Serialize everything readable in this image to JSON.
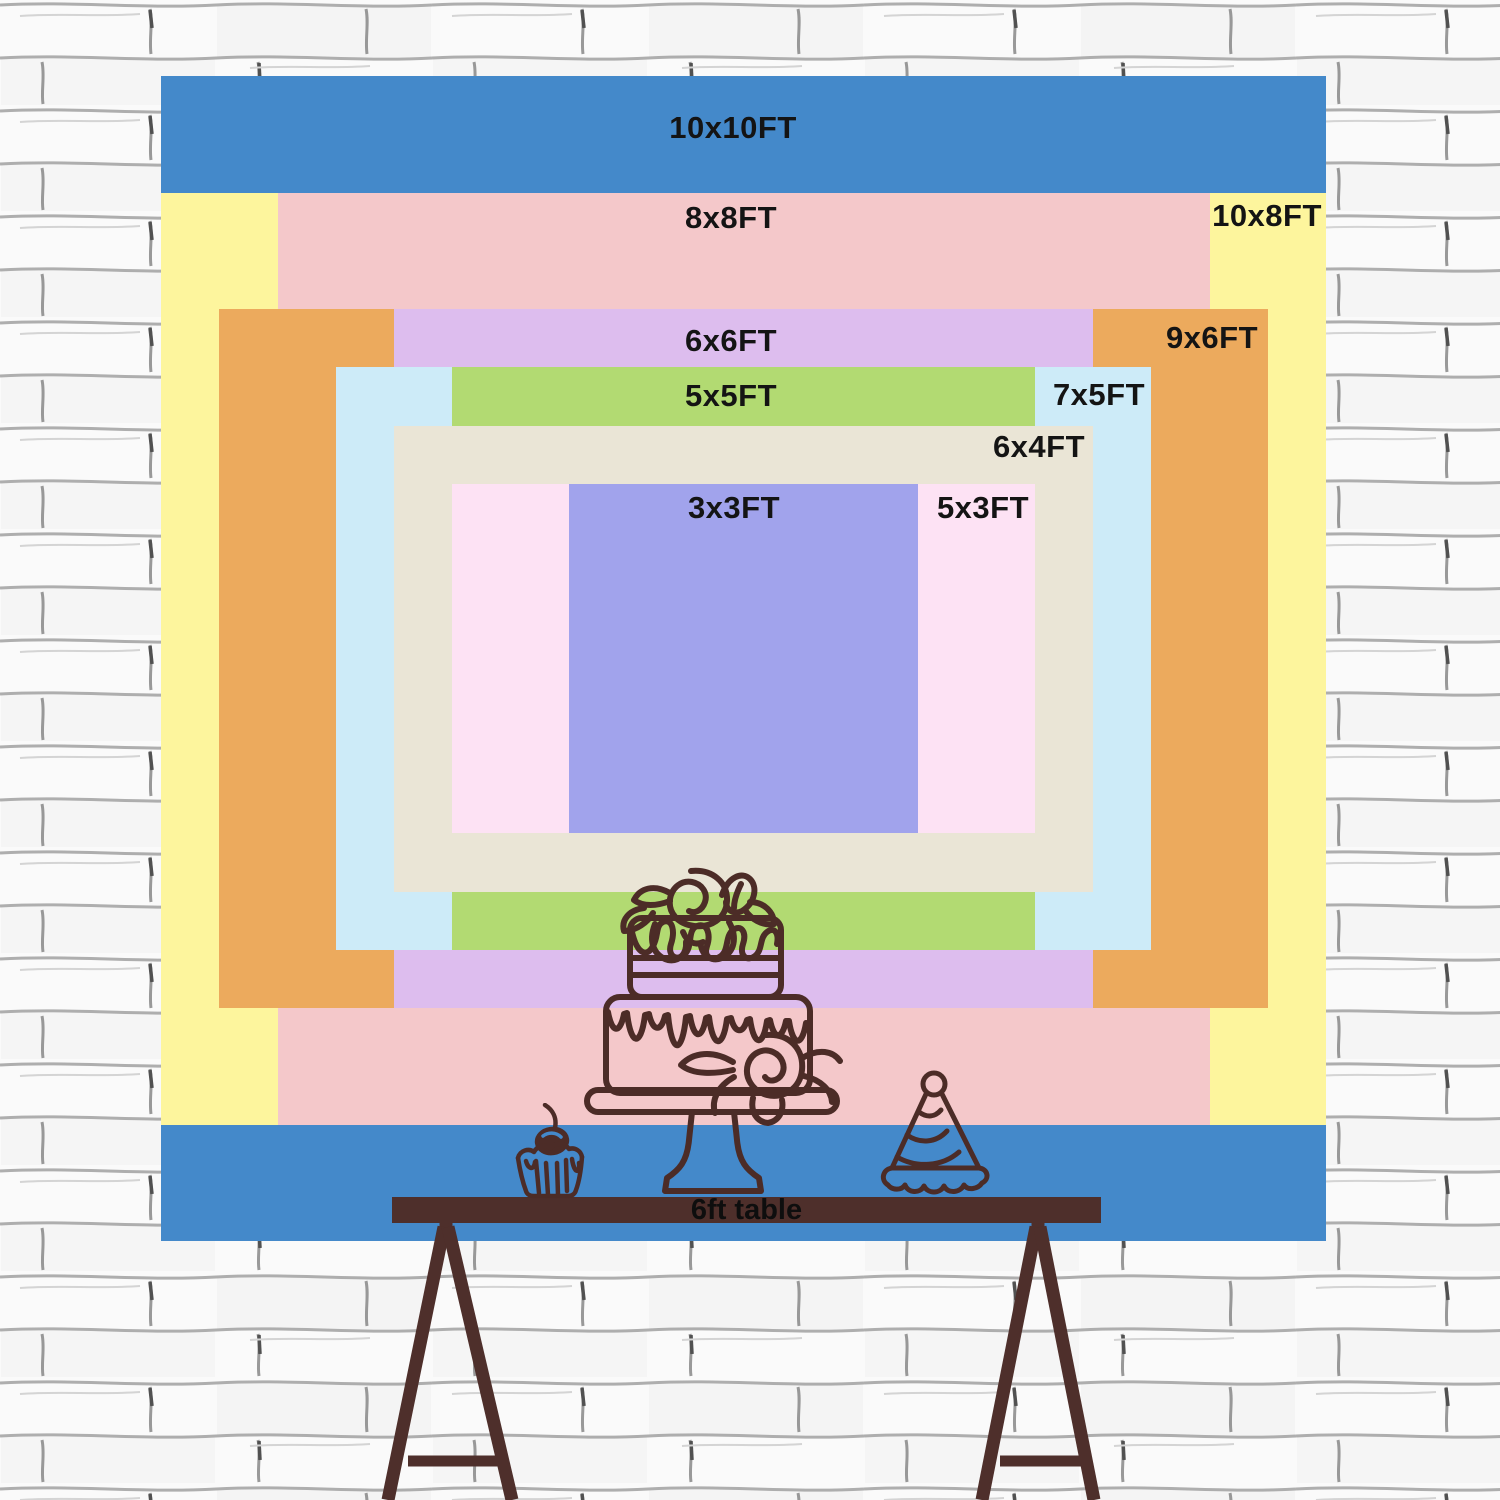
{
  "backdrop_chart": {
    "px_per_ft": 116.5,
    "area": {
      "left": 161,
      "top": 76,
      "size": 1165
    },
    "sizes": [
      {
        "id": "10x10",
        "label": "10x10FT",
        "w_ft": 10,
        "h_ft": 10,
        "color": "#4489ca",
        "label_x": 572,
        "label_y": 52
      },
      {
        "id": "10x8",
        "label": "10x8FT",
        "w_ft": 10,
        "h_ft": 8,
        "color": "#fdf59d",
        "label_x": 1106,
        "label_y": 140
      },
      {
        "id": "8x8",
        "label": "8x8FT",
        "w_ft": 8,
        "h_ft": 8,
        "color": "#f4c8ca",
        "label_x": 570,
        "label_y": 142
      },
      {
        "id": "9x6",
        "label": "9x6FT",
        "w_ft": 9,
        "h_ft": 6,
        "color": "#ecaa5d",
        "label_x": 1051,
        "label_y": 262
      },
      {
        "id": "6x6",
        "label": "6x6FT",
        "w_ft": 6,
        "h_ft": 6,
        "color": "#ddbdee",
        "label_x": 570,
        "label_y": 265
      },
      {
        "id": "7x5",
        "label": "7x5FT",
        "w_ft": 7,
        "h_ft": 5,
        "color": "#cdebf8",
        "label_x": 938,
        "label_y": 319
      },
      {
        "id": "5x5",
        "label": "5x5FT",
        "w_ft": 5,
        "h_ft": 5,
        "color": "#b2da72",
        "label_x": 570,
        "label_y": 320
      },
      {
        "id": "6x4",
        "label": "6x4FT",
        "w_ft": 6,
        "h_ft": 4,
        "color": "#eae5d6",
        "label_x": 878,
        "label_y": 371
      },
      {
        "id": "5x3",
        "label": "5x3FT",
        "w_ft": 5,
        "h_ft": 3,
        "color": "#fde2f4",
        "label_x": 822,
        "label_y": 432
      },
      {
        "id": "3x3",
        "label": "3x3FT",
        "w_ft": 3,
        "h_ft": 3,
        "color": "#a1a3ec",
        "label_x": 573,
        "label_y": 432
      }
    ],
    "table": {
      "label": "6ft table",
      "bar_color": "#4e2f2b",
      "text_color": "#0e0e0e"
    },
    "decorations": {
      "icons": [
        "two-tier-birthday-cake-icon",
        "cupcake-with-cherry-icon",
        "party-hat-icon"
      ],
      "stroke_color": "#4c2c27"
    },
    "wall": {
      "background": "#fafafa",
      "mortar_line_color": "#9b9b9b"
    }
  }
}
